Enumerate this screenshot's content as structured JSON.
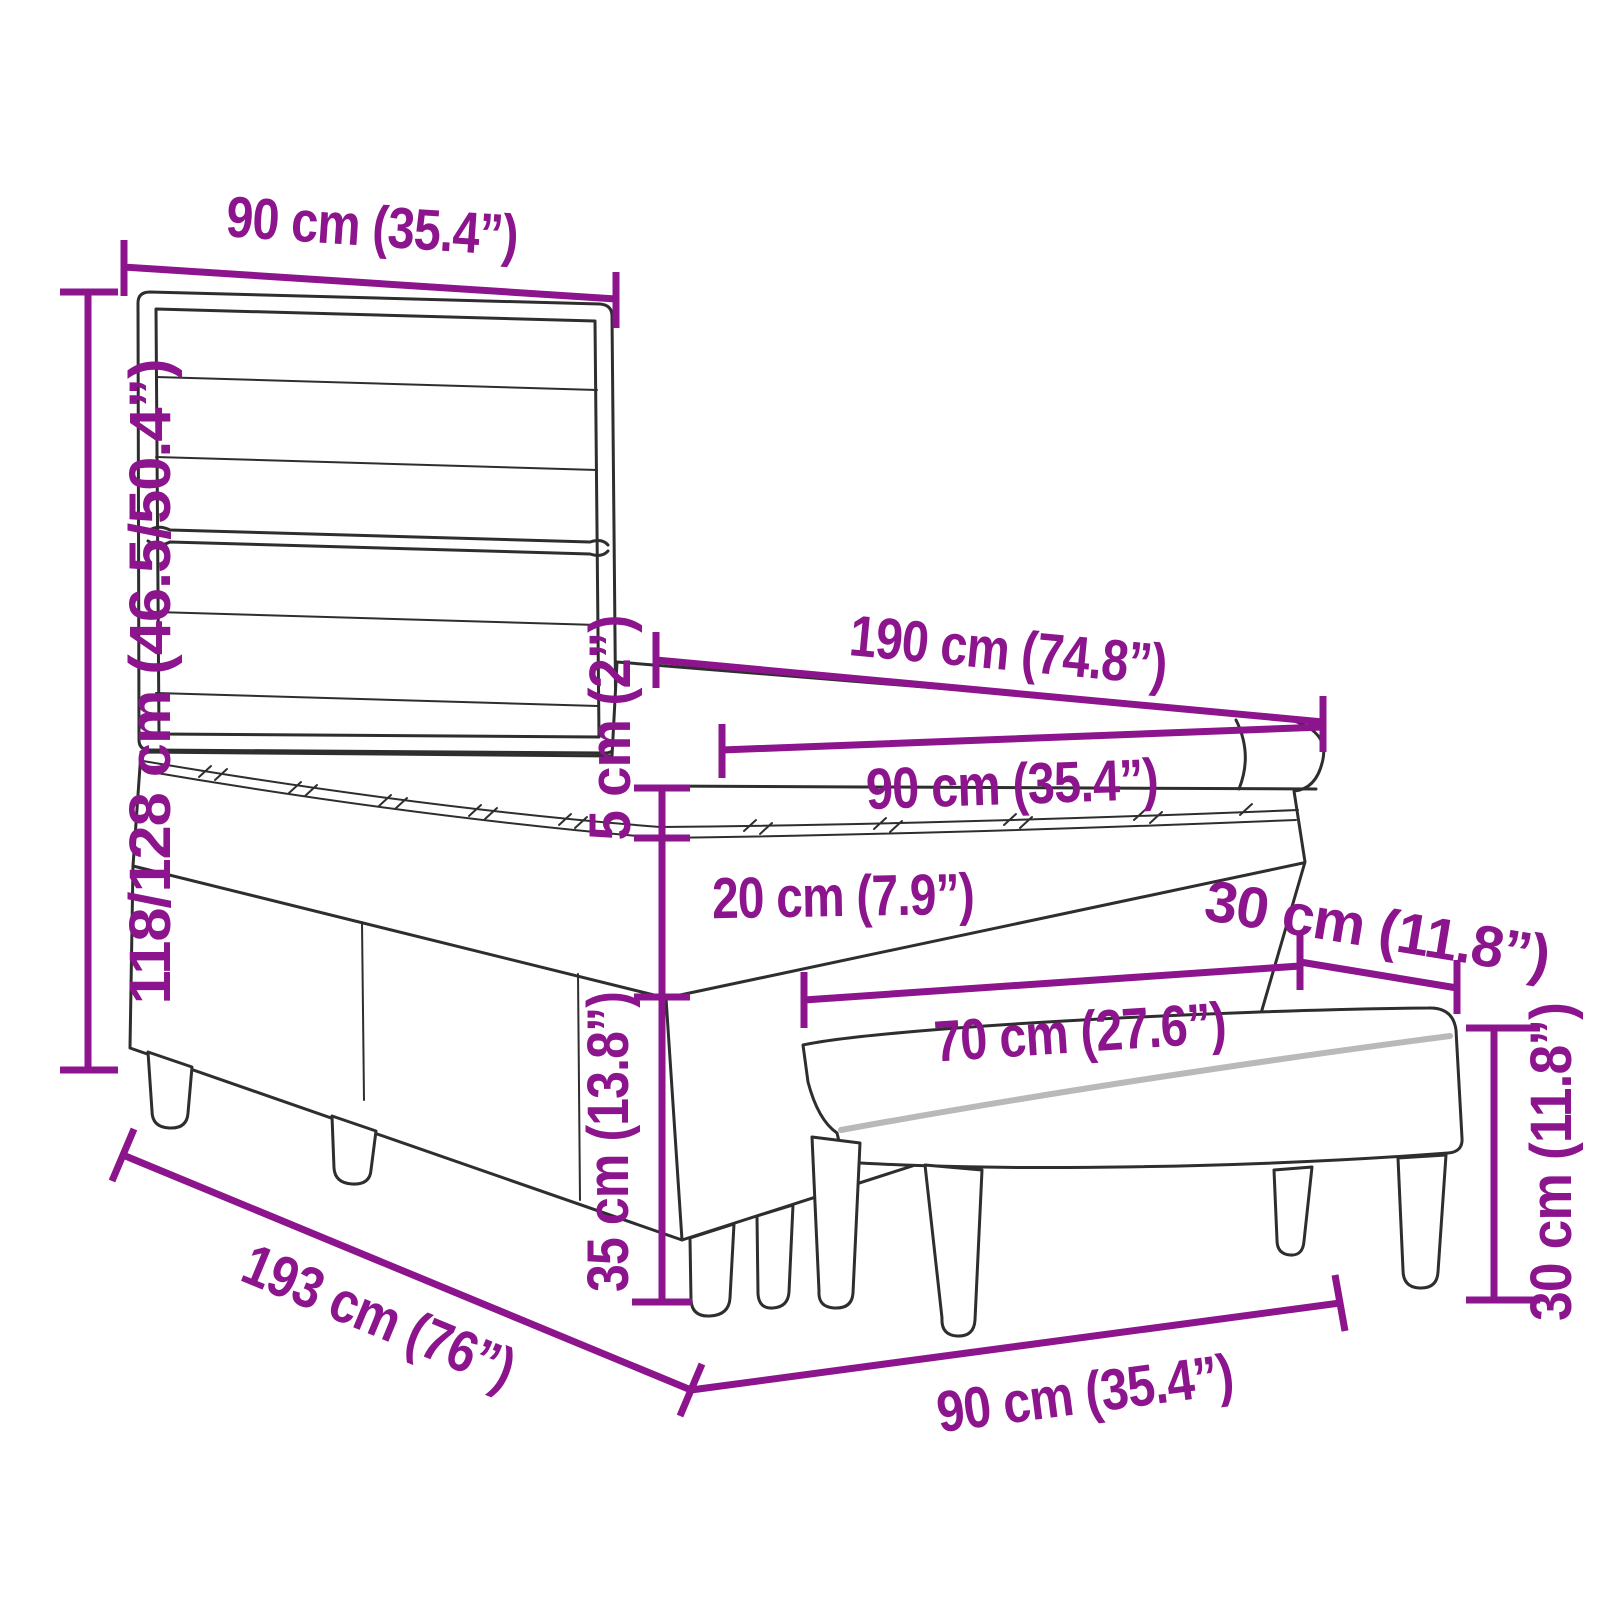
{
  "palette": {
    "dimension_color": "#8C148C",
    "outline_color": "#2e2e2e",
    "piping_color": "#b9b9b9",
    "background_color": "#ffffff"
  },
  "dimensions": {
    "headboard_width": {
      "label": "90 cm (35.4”)"
    },
    "headboard_height": {
      "label": "118/128 cm (46.5/50.4”)"
    },
    "mattress_length": {
      "label": "190 cm (74.8”)"
    },
    "mattress_width": {
      "label": "90 cm (35.4”)"
    },
    "topper_thickness": {
      "label": "5 cm (2”)"
    },
    "mattress_thickness": {
      "label": "20 cm (7.9”)"
    },
    "base_height": {
      "label": "35 cm (13.8”)"
    },
    "bench_depth": {
      "label": "30 cm (11.8”)"
    },
    "bench_length": {
      "label": "70 cm (27.6”)"
    },
    "bench_height": {
      "label": "30 cm (11.8”)"
    },
    "bed_length": {
      "label": "193 cm (76”)"
    },
    "bed_width": {
      "label": "90 cm (35.4”)"
    }
  }
}
